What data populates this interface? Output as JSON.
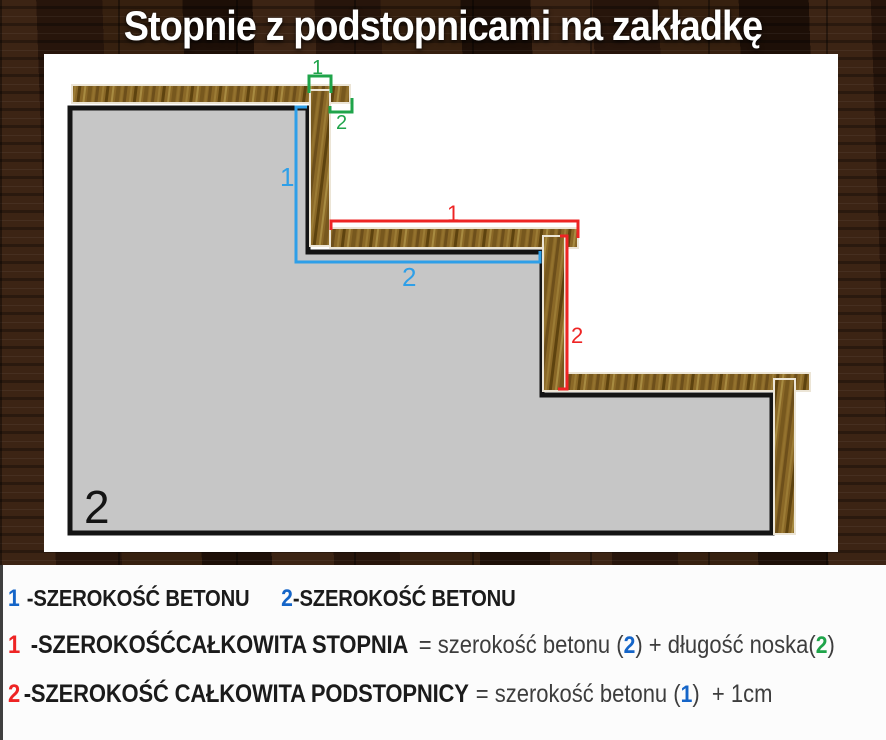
{
  "title": "Stopnie z podstopnicami na zakładkę",
  "colors": {
    "blue_bracket": "#2e9fe8",
    "blue_number": "#1565c8",
    "green": "#1fa44a",
    "red": "#ee2424",
    "concrete_fill": "#c6c6c6",
    "outline_black": "#141414",
    "wood_base": "#8a6827",
    "panel_white": "#ffffff",
    "legend_gray": "#3d3d3d",
    "legend_black": "#1b1b1b"
  },
  "diagram": {
    "marks": {
      "green_1": "1",
      "green_2": "2",
      "blue_1": "1",
      "blue_2": "2",
      "red_1": "1",
      "red_2": "2",
      "concrete_label": "2"
    }
  },
  "legend": {
    "line1": {
      "num1": "1",
      "text1": "-SZEROKOŚĆ BETONU",
      "num2": "2",
      "text2": "-SZEROKOŚĆ BETONU"
    },
    "line2": {
      "num": "1",
      "bold": "-SZEROKOŚĆCAŁKOWITA STOPNIA",
      "eq1": "= szerokość betonu (",
      "ref1": "2",
      "eq2": ") + długość noska(",
      "ref2": "2",
      "eq3": ")"
    },
    "line3": {
      "num": "2",
      "bold": "-SZEROKOŚĆ CAŁKOWITA PODSTOPNICY",
      "eq1": "= szerokość betonu (",
      "ref1": "1",
      "eq2": ")  + 1cm"
    }
  }
}
